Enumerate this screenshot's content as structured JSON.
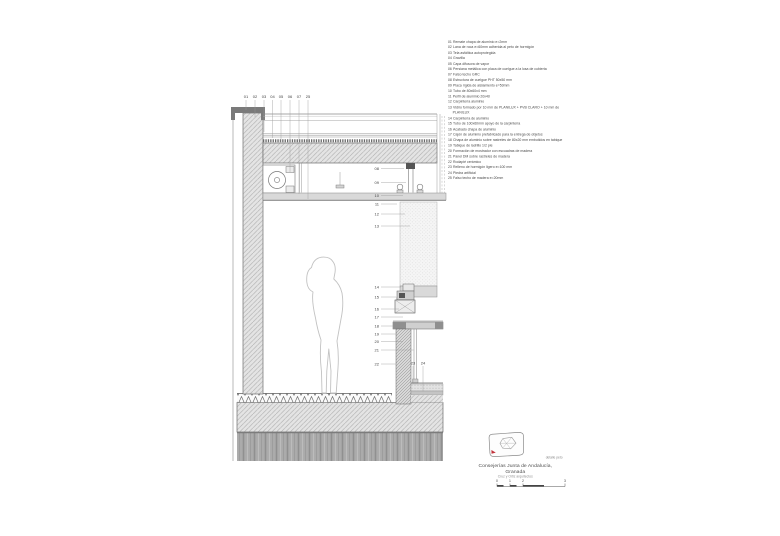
{
  "drawing": {
    "callouts": {
      "c01": "01",
      "c02": "02",
      "c03": "03",
      "c04": "04",
      "c05": "05",
      "c06": "06",
      "c07": "07",
      "c08": "08",
      "c09": "09",
      "c10": "10",
      "c11": "11",
      "c12": "12",
      "c13": "13",
      "c14": "14",
      "c15": "15",
      "c16": "16",
      "c17": "17",
      "c18": "18",
      "c19": "19",
      "c20": "20",
      "c21": "21",
      "c22": "22",
      "c23": "23",
      "c24": "24",
      "c25": "25"
    }
  },
  "legend": {
    "items": [
      {
        "num": "01",
        "text": "Remate chapa de aluminio e=2mm"
      },
      {
        "num": "02",
        "text": "Lana de roca e=60mm adherida al peto de hormigón"
      },
      {
        "num": "03",
        "text": "Tela asfáltica autoprotegida"
      },
      {
        "num": "04",
        "text": "Gravilla"
      },
      {
        "num": "05",
        "text": "Capa difusora de vapor"
      },
      {
        "num": "06",
        "text": "Persiana metálica con placa de cuelgue a la losa de cubierta"
      },
      {
        "num": "07",
        "text": "Falso techo GRC"
      },
      {
        "num": "08",
        "text": "Estructura de cuelgue PHT 50x50 mm"
      },
      {
        "num": "09",
        "text": "Placa rígida de aislamiento e=50mm"
      },
      {
        "num": "10",
        "text": "Tubo de 80x60x4 mm"
      },
      {
        "num": "11",
        "text": "Perfil de aluminio 20x40"
      },
      {
        "num": "12",
        "text": "Carpintería aluminio"
      },
      {
        "num": "13",
        "text": "Vidrio formado por 10 mm de PLANILUX + PVB CLARO + 10 mm de PLANILUX"
      },
      {
        "num": "14",
        "text": "Carpintería de aluminio"
      },
      {
        "num": "15",
        "text": "Tubo de 100x60mm apoyo de la carpintería"
      },
      {
        "num": "16",
        "text": "Acabado chapa de aluminio"
      },
      {
        "num": "17",
        "text": "Cajón de aluminio prefabricado para la entrega de objetos"
      },
      {
        "num": "18",
        "text": "Chapa de aluminio sobre rastreles de 80x20 mm embutidos en tabique"
      },
      {
        "num": "19",
        "text": "Tabique de ladrillo 1/2 pie"
      },
      {
        "num": "20",
        "text": "Formación de mostrador con escuadras de madera"
      },
      {
        "num": "21",
        "text": "Panel DM sobre rastreles de madera"
      },
      {
        "num": "22",
        "text": "Rodapié cerámico"
      },
      {
        "num": "23",
        "text": "Relleno de hormigón ligero e=100 mm"
      },
      {
        "num": "24",
        "text": "Piedra artificial"
      },
      {
        "num": "25",
        "text": "Falso techo de madera e=20mm"
      }
    ]
  },
  "titleblock": {
    "caption": "detalle peto",
    "project": "Consejerías Junta de Andalucía, Granada",
    "firm": "Cruz y Ortiz arquitectos"
  },
  "scalebar": {
    "labels": [
      "0",
      "1",
      "2",
      "3"
    ]
  },
  "colors": {
    "line_dark": "#555555",
    "line_mid": "#888888",
    "hatch_fill": "#e4e4e4",
    "cap_gray": "#7a7a7a",
    "accent_red": "#c2333b"
  }
}
